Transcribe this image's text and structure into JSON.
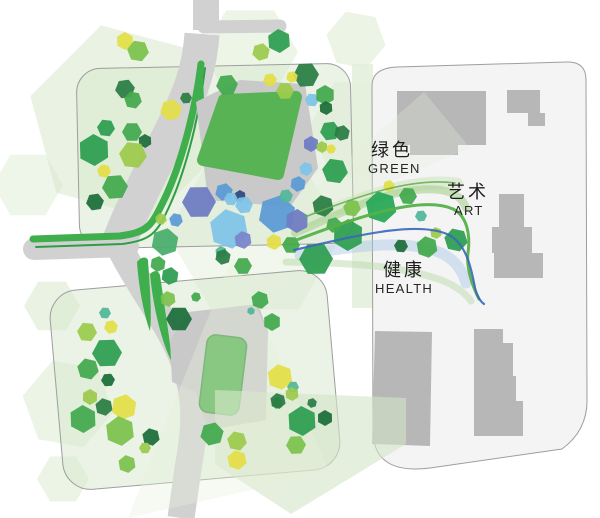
{
  "labels": {
    "green": {
      "zh": "绿色",
      "en": "GREEN"
    },
    "art": {
      "zh": "艺术",
      "en": "ART"
    },
    "health": {
      "zh": "健康",
      "en": "HEALTH"
    }
  },
  "palette": {
    "road": "#d1d1d1",
    "plaza": "#c9c9c9",
    "building": "#b7b7b7",
    "roof": "#58b355",
    "roof_edge": "#46994a",
    "parcel_fill": "rgba(214,232,204,0.5)",
    "parcel_right_fill": "#f4f4f5",
    "parcel_stroke": "#9e9e9e",
    "median": "#e3efda",
    "path_green": "#3fae4c",
    "path_green_dark": "#2e9e44",
    "tree": {
      "green": "#44a94f",
      "green2": "#2f9e52",
      "green3": "#4aad6d",
      "bright": "#27a857",
      "dark": "#1e6e3c",
      "dark2": "#2c7d45",
      "yg": "#9ccb4e",
      "yg2": "#7cc24e",
      "yellow": "#e2de48",
      "teal": "#52b79a",
      "lblue": "#7fc3e8",
      "blue": "#5b9bd5",
      "peri": "#6d7cc3",
      "violet": "#7a86cc",
      "navy": "#2e4b7e"
    }
  },
  "map": {
    "washes": [
      {
        "x": 127,
        "y": 122,
        "r": 100,
        "rot": 15,
        "c": "#d5e6c8",
        "o": 0.5
      },
      {
        "x": 250,
        "y": 52,
        "r": 48,
        "rot": 0,
        "c": "#dcebd0",
        "o": 0.5
      },
      {
        "x": 356,
        "y": 40,
        "r": 30,
        "rot": 10,
        "c": "#dcebd0",
        "o": 0.55
      },
      {
        "x": 362,
        "y": 130,
        "r": 55,
        "rot": 0,
        "c": "#dcebd0",
        "o": 0.4
      },
      {
        "x": 507,
        "y": 153,
        "r": 47,
        "rot": 8,
        "c": "#dfecd2",
        "o": 0.75
      },
      {
        "x": 488,
        "y": 340,
        "r": 52,
        "rot": 0,
        "c": "#dfecd2",
        "o": 0.5
      },
      {
        "x": 52,
        "y": 306,
        "r": 28,
        "rot": 0,
        "c": "#d5e6c8",
        "o": 0.5
      },
      {
        "x": 68,
        "y": 404,
        "r": 46,
        "rot": 10,
        "c": "#d5e6c8",
        "o": 0.45
      },
      {
        "x": 63,
        "y": 479,
        "r": 26,
        "rot": 0,
        "c": "#d5e6c8",
        "o": 0.45
      },
      {
        "x": 255,
        "y": 233,
        "r": 88,
        "rot": 0,
        "c": "#dcead0",
        "o": 0.4
      },
      {
        "x": 430,
        "y": 262,
        "r": 40,
        "rot": 0,
        "c": "#dcead0",
        "o": 0.35
      },
      {
        "x": 28,
        "y": 185,
        "r": 35,
        "rot": 0,
        "c": "#d5e6c8",
        "o": 0.4
      }
    ],
    "overlays": [
      {
        "pts": "215,390 406,398 406,444 291,514 215,464",
        "c": "#d3e4c6",
        "o": 0.6
      },
      {
        "pts": "233,255 128,518 330,472",
        "c": "#e4f0da",
        "o": 0.35
      },
      {
        "pts": "258,238 424,92 470,148",
        "c": "#e4f0da",
        "o": 0.3
      }
    ],
    "median": {
      "x": 352,
      "y": 64,
      "w": 21,
      "h": 244,
      "o": 0.85
    },
    "parcels": [
      {
        "kind": "rect",
        "x": 78,
        "y": 66,
        "w": 274,
        "h": 180,
        "rx": 24,
        "rot": "-1.2 215 156",
        "fill": "parcel_fill"
      },
      {
        "kind": "rect",
        "x": 56,
        "y": 280,
        "w": 278,
        "h": 200,
        "rx": 28,
        "rot": "-5 195 380",
        "fill": "parcel_fill"
      },
      {
        "kind": "path",
        "d": "M397,67 L566,62 Q586,61 586,80 L587,398 Q588,430 562,449 L430,468 Q374,475 373,432 L372,86 Q372,68 397,67 Z",
        "fill": "parcel_right_fill"
      }
    ],
    "roads": [
      {
        "d": "M206,0 L206,30",
        "w": 26
      },
      {
        "d": "M204,27 L280,26",
        "w": 13,
        "cap": "round"
      },
      {
        "d": "M202,34 C200,62 194,84 180,114 C160,156 132,206 117,248",
        "w": 35
      },
      {
        "d": "M34,249 L128,246",
        "w": 22,
        "cap": "round"
      },
      {
        "d": "M118,244 C142,292 170,324 184,362 C196,395 196,424 189,462 L181,518",
        "w": 27
      }
    ],
    "green_paths": [
      {
        "d": "M33,239 L120,236 C147,232 151,227 163,202 C178,172 194,120 201,64",
        "w": 7,
        "c": "path_green"
      },
      {
        "d": "M36,247 L122,244 C152,240 157,233 169,207 C183,177 198,126 205,68",
        "w": 2,
        "c": "path_green_dark"
      },
      {
        "d": "M200,64 L202,112",
        "w": 5,
        "c": "path_green"
      }
    ],
    "green_slivers": [
      {
        "d": "M137,262 C141,257 146,256 148,260 C150,290 152,315 150,331 C145,318 139,291 137,262 Z"
      },
      {
        "d": "M150,274 C154,270 158,270 160,275 C165,310 170,340 172,362 C165,350 154,316 150,274 Z"
      }
    ],
    "plazas": [
      {
        "d": "M196,102 L240,80 L305,84 L318,168 L290,207 L208,200 Z"
      },
      {
        "d": "M188,312 L258,304 L268,332 L266,420 L208,430 L196,392 L172,382 L170,340 Z"
      }
    ],
    "buildings": [
      {
        "d": "M397,91 L486,91 L486,145 L458,145 L458,155 L410,155 L410,145 L397,145 Z"
      },
      {
        "d": "M507,90 L540,90 L540,113 L545,113 L545,126 L528,126 L528,113 L507,113 Z"
      },
      {
        "d": "M499,194 L524,194 L524,227 L532,227 L532,253 L543,253 L543,278 L494,278 L494,253 L492,253 L492,227 L499,227 Z"
      },
      {
        "d": "M375,331 L432,332 L430,446 L372,444 Z"
      },
      {
        "d": "M474,329 L503,329 L503,343 L513,343 L513,376 L516,376 L516,401 L523,401 L523,436 L474,436 Z"
      }
    ],
    "roof_upper": {
      "d": "M224,100 L296,97 L278,174 L203,160 Z",
      "edge": 12
    },
    "roof_lower": {
      "x": 203,
      "y": 336,
      "w": 40,
      "h": 78,
      "rx": 9,
      "rot": "7 223 375"
    },
    "ribbon_bands": [
      {
        "d": "M310,220 C360,198 412,178 457,184",
        "w": 13,
        "c": "#cfe3bd",
        "o": 0.55
      },
      {
        "d": "M295,233 C345,212 395,184 441,190 C456,193 463,199 466,208",
        "w": 8,
        "c": "#a6d18f",
        "o": 0.6
      },
      {
        "d": "M300,255 C350,247 406,238 441,253 C456,260 463,272 466,283",
        "w": 11,
        "c": "#a9c6e6",
        "o": 0.45
      },
      {
        "d": "M286,262 C340,263 402,264 446,282 C459,288 466,294 471,301",
        "w": 7,
        "c": "#bcd9ab",
        "o": 0.5
      }
    ],
    "ribbon_lines": [
      {
        "d": "M291,242 C350,220 420,194 453,209 C469,217 470,239 468,253 C466,270 473,287 479,299",
        "w": 3,
        "c": "#54b149",
        "o": 0.95
      },
      {
        "d": "M294,250 C355,236 421,219 451,236 C466,246 471,266 475,288 C477,296 480,301 484,304",
        "w": 2.2,
        "c": "#3a67bd",
        "o": 0.9
      },
      {
        "d": "M305,217 C358,196 412,177 455,183",
        "w": 1.6,
        "c": "#5fae4e",
        "o": 0.85
      }
    ],
    "trees": [
      [
        125,
        41,
        9,
        "yellow"
      ],
      [
        138,
        51,
        11,
        "yg2"
      ],
      [
        279,
        41,
        12,
        "green2"
      ],
      [
        261,
        52,
        9,
        "yg"
      ],
      [
        227,
        85,
        11,
        "green"
      ],
      [
        270,
        80,
        7,
        "yellow"
      ],
      [
        285,
        91,
        9,
        "yg"
      ],
      [
        306,
        75,
        13,
        "dark2"
      ],
      [
        292,
        77,
        6,
        "yellow"
      ],
      [
        312,
        100,
        7,
        "lblue"
      ],
      [
        325,
        95,
        10,
        "green"
      ],
      [
        326,
        108,
        7,
        "dark"
      ],
      [
        186,
        98,
        6,
        "dark2"
      ],
      [
        125,
        89,
        10,
        "dark2"
      ],
      [
        133,
        100,
        9,
        "green"
      ],
      [
        171,
        110,
        11,
        "yellow"
      ],
      [
        106,
        128,
        9,
        "green2"
      ],
      [
        132,
        132,
        10,
        "green"
      ],
      [
        145,
        141,
        7,
        "dark"
      ],
      [
        94,
        150,
        16,
        "green2"
      ],
      [
        133,
        155,
        14,
        "yg"
      ],
      [
        104,
        171,
        7,
        "yellow"
      ],
      [
        115,
        187,
        13,
        "green"
      ],
      [
        95,
        202,
        9,
        "dark"
      ],
      [
        161,
        219,
        6,
        "yg"
      ],
      [
        176,
        220,
        7,
        "blue"
      ],
      [
        165,
        242,
        14,
        "green3"
      ],
      [
        158,
        264,
        8,
        "green"
      ],
      [
        170,
        276,
        9,
        "green2"
      ],
      [
        199,
        202,
        17,
        "peri"
      ],
      [
        224,
        192,
        9,
        "blue"
      ],
      [
        240,
        196,
        6,
        "navy"
      ],
      [
        231,
        199,
        7,
        "lblue"
      ],
      [
        244,
        205,
        9,
        "lblue"
      ],
      [
        229,
        229,
        20,
        "lblue"
      ],
      [
        277,
        214,
        19,
        "blue"
      ],
      [
        297,
        221,
        12,
        "peri"
      ],
      [
        298,
        184,
        8,
        "blue"
      ],
      [
        306,
        169,
        7,
        "lblue"
      ],
      [
        286,
        196,
        7,
        "teal"
      ],
      [
        243,
        240,
        9,
        "violet"
      ],
      [
        221,
        252,
        6,
        "teal"
      ],
      [
        223,
        257,
        8,
        "dark2"
      ],
      [
        274,
        242,
        8,
        "yellow"
      ],
      [
        291,
        245,
        9,
        "green"
      ],
      [
        316,
        259,
        17,
        "green2"
      ],
      [
        348,
        235,
        16,
        "green2"
      ],
      [
        260,
        300,
        9,
        "green"
      ],
      [
        179,
        319,
        13,
        "dark"
      ],
      [
        168,
        299,
        8,
        "yg2"
      ],
      [
        196,
        297,
        5,
        "green"
      ],
      [
        251,
        311,
        4,
        "teal"
      ],
      [
        243,
        266,
        9,
        "green"
      ],
      [
        323,
        206,
        11,
        "dark2"
      ],
      [
        335,
        171,
        13,
        "green2"
      ],
      [
        352,
        208,
        9,
        "yg2"
      ],
      [
        334,
        225,
        8,
        "green"
      ],
      [
        330,
        131,
        10,
        "green2"
      ],
      [
        342,
        133,
        8,
        "dark2"
      ],
      [
        311,
        144,
        8,
        "peri"
      ],
      [
        322,
        147,
        6,
        "yg"
      ],
      [
        331,
        149,
        5,
        "yellow"
      ],
      [
        381,
        207,
        16,
        "bright"
      ],
      [
        389,
        186,
        6,
        "yellow"
      ],
      [
        408,
        196,
        9,
        "green"
      ],
      [
        401,
        246,
        7,
        "dark"
      ],
      [
        427,
        247,
        11,
        "green"
      ],
      [
        436,
        233,
        6,
        "yg"
      ],
      [
        456,
        240,
        12,
        "green2"
      ],
      [
        421,
        216,
        6,
        "teal"
      ],
      [
        105,
        313,
        6,
        "teal"
      ],
      [
        87,
        332,
        10,
        "yg"
      ],
      [
        111,
        327,
        7,
        "yellow"
      ],
      [
        107,
        353,
        15,
        "green2"
      ],
      [
        88,
        369,
        11,
        "green"
      ],
      [
        108,
        380,
        7,
        "dark"
      ],
      [
        90,
        397,
        8,
        "yg"
      ],
      [
        104,
        407,
        9,
        "dark2"
      ],
      [
        124,
        407,
        13,
        "yellow"
      ],
      [
        83,
        419,
        14,
        "green"
      ],
      [
        120,
        431,
        15,
        "yg2"
      ],
      [
        151,
        437,
        9,
        "dark"
      ],
      [
        145,
        448,
        6,
        "yg"
      ],
      [
        127,
        464,
        9,
        "yg2"
      ],
      [
        212,
        434,
        12,
        "green"
      ],
      [
        237,
        441,
        10,
        "yg"
      ],
      [
        237,
        460,
        10,
        "yellow"
      ],
      [
        277,
        403,
        6,
        "green2"
      ],
      [
        302,
        421,
        15,
        "green2"
      ],
      [
        325,
        418,
        8,
        "dark"
      ],
      [
        312,
        403,
        5,
        "dark2"
      ],
      [
        296,
        445,
        10,
        "yg2"
      ],
      [
        272,
        322,
        9,
        "green"
      ],
      [
        280,
        377,
        13,
        "yellow"
      ],
      [
        293,
        387,
        6,
        "teal"
      ],
      [
        292,
        394,
        7,
        "yg"
      ],
      [
        278,
        401,
        8,
        "dark2"
      ]
    ]
  }
}
